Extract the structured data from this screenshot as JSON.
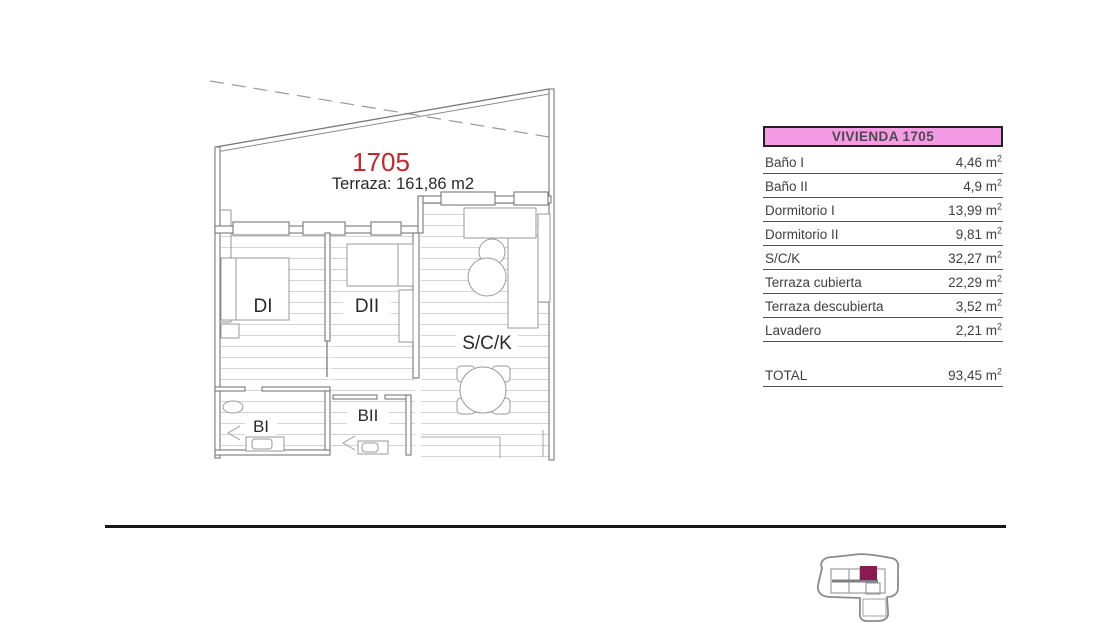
{
  "plan": {
    "unit_number": "1705",
    "terrace_label": "Terraza: 161,86 m2",
    "room_labels": {
      "dormitorio1": "DI",
      "dormitorio2": "DII",
      "salon_cocina": "S/C/K",
      "bano1": "BI",
      "bano2": "BII"
    }
  },
  "table": {
    "header": "VIVIENDA 1705",
    "unit": "m",
    "unit_exp": "2",
    "rows": [
      {
        "label": "Baño I",
        "value": "4,46"
      },
      {
        "label": "Baño II",
        "value": "4,9"
      },
      {
        "label": "Dormitorio I",
        "value": "13,99"
      },
      {
        "label": "Dormitorio II",
        "value": "9,81"
      },
      {
        "label": "S/C/K",
        "value": "32,27"
      },
      {
        "label": "Terraza cubierta",
        "value": "22,29"
      },
      {
        "label": "Terraza descubierta",
        "value": "3,52"
      },
      {
        "label": "Lavadero",
        "value": "2,21"
      }
    ],
    "total": {
      "label": "TOTAL",
      "value": "93,45"
    }
  },
  "colors": {
    "header_pink": "#F59BE5",
    "unit_red": "#C3272B",
    "locator_maroon": "#8B1A52"
  }
}
